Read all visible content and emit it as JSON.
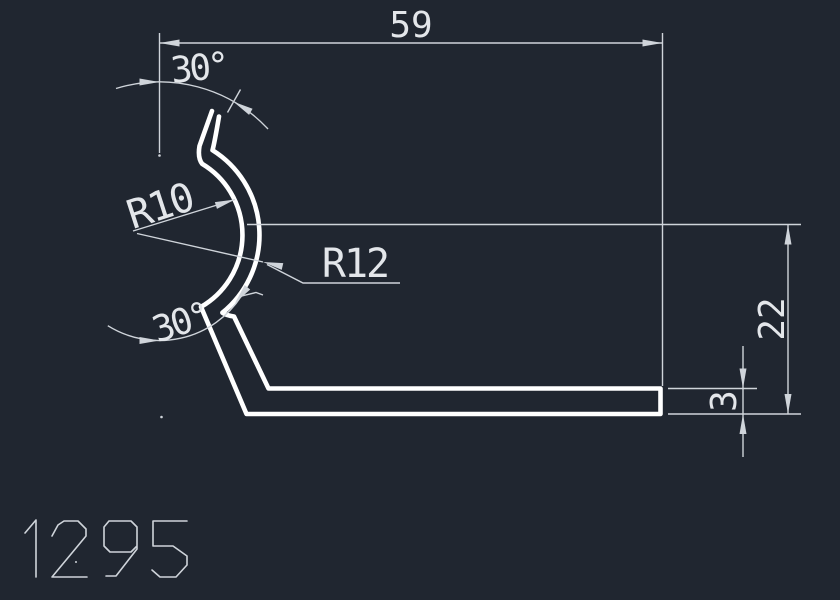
{
  "canvas": {
    "background": "#202630",
    "geometry_color": "#ffffff",
    "dimension_color": "#cfd4da",
    "text_color": "#e3e6ea"
  },
  "drawing": {
    "part_number": "1295",
    "dimensions": {
      "length": {
        "label": "59"
      },
      "height": {
        "label": "22"
      },
      "thickness": {
        "label": "3"
      },
      "inner_radius": {
        "label": "R10"
      },
      "outer_radius": {
        "label": "R12"
      },
      "top_angle": {
        "label": "30°"
      },
      "bottom_angle": {
        "label": "30°"
      }
    }
  }
}
